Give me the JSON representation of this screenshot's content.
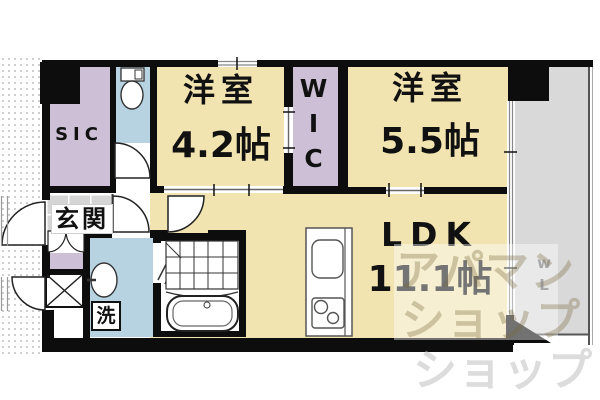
{
  "plan": {
    "rooms": {
      "sic": {
        "label": "SIC"
      },
      "wic": {
        "label": "WIC"
      },
      "western_room_small": {
        "label": "洋室",
        "size": "4.2帖"
      },
      "western_room_large": {
        "label": "洋室",
        "size": "5.5帖"
      },
      "ldk": {
        "label": "LDK",
        "size": "11.1帖"
      },
      "entrance": {
        "label": "玄関"
      },
      "laundry": {
        "label": "洗"
      }
    },
    "watermark": {
      "line1": "アパマン",
      "line2": "ショップ",
      "line3": "ショップ",
      "side": "wL"
    },
    "icons": {
      "toilet": "toilet-icon",
      "bathtub": "bathtub-icon",
      "washbasin": "washbasin-icon",
      "gas_stove": "stove-icon",
      "kitchen_sink": "kitchen-sink-icon",
      "pipe_shaft": "pipe-shaft-x-icon",
      "door_swings": "door-swing-arc"
    },
    "colors": {
      "room_floor": "#f2e4b0",
      "closet_lavender": "#cdc0d6",
      "wet_area_blue": "#b7d3e2",
      "balcony_gray": "#d9d9d9",
      "entrance_tile_gray": "#d5d5d5",
      "wall_black": "#0d0d0d"
    }
  }
}
